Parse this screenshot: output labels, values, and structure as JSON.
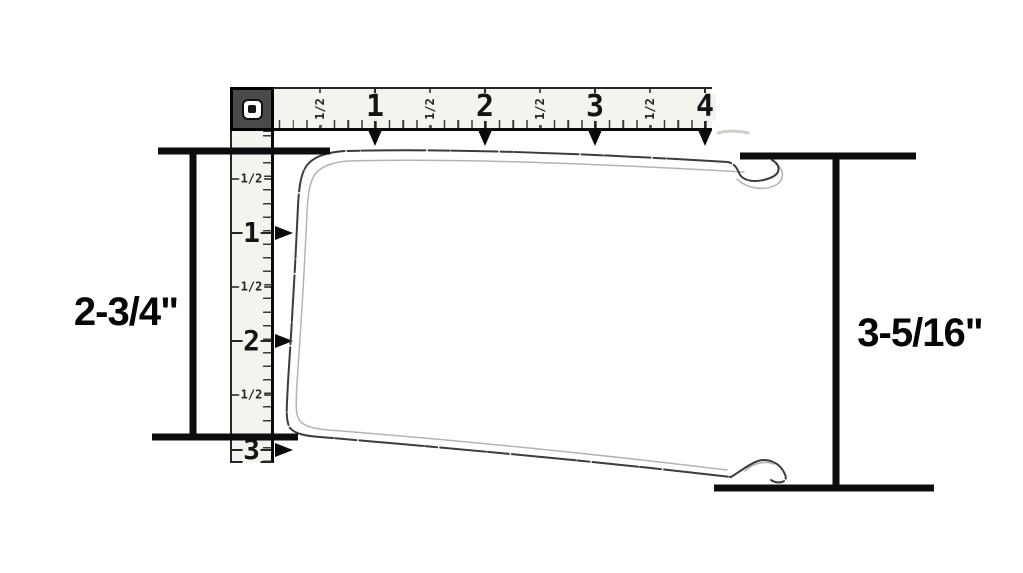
{
  "colors": {
    "ink": "#0d0d0d",
    "sketch_dark": "#3c3c3c",
    "sketch_light": "#b3b3b0",
    "ruler_bg": "#f5f3ee",
    "block_bg": "#4a4a4a"
  },
  "dimension_callouts": {
    "left": {
      "label": "2-3/4\""
    },
    "right": {
      "label": "3-5/16\""
    }
  },
  "horizontal_ruler": {
    "origin_label": "0",
    "majors": [
      {
        "text": "1"
      },
      {
        "text": "2"
      },
      {
        "text": "3"
      },
      {
        "text": "4"
      }
    ],
    "halves": [
      {
        "text": "1/2"
      },
      {
        "text": "1/2"
      },
      {
        "text": "1/2"
      },
      {
        "text": "1/2"
      }
    ]
  },
  "vertical_ruler": {
    "majors": [
      {
        "text": "1"
      },
      {
        "text": "2"
      },
      {
        "text": "3"
      }
    ],
    "halves": [
      {
        "text": "1/2"
      },
      {
        "text": "1/2"
      },
      {
        "text": "1/2"
      }
    ]
  }
}
